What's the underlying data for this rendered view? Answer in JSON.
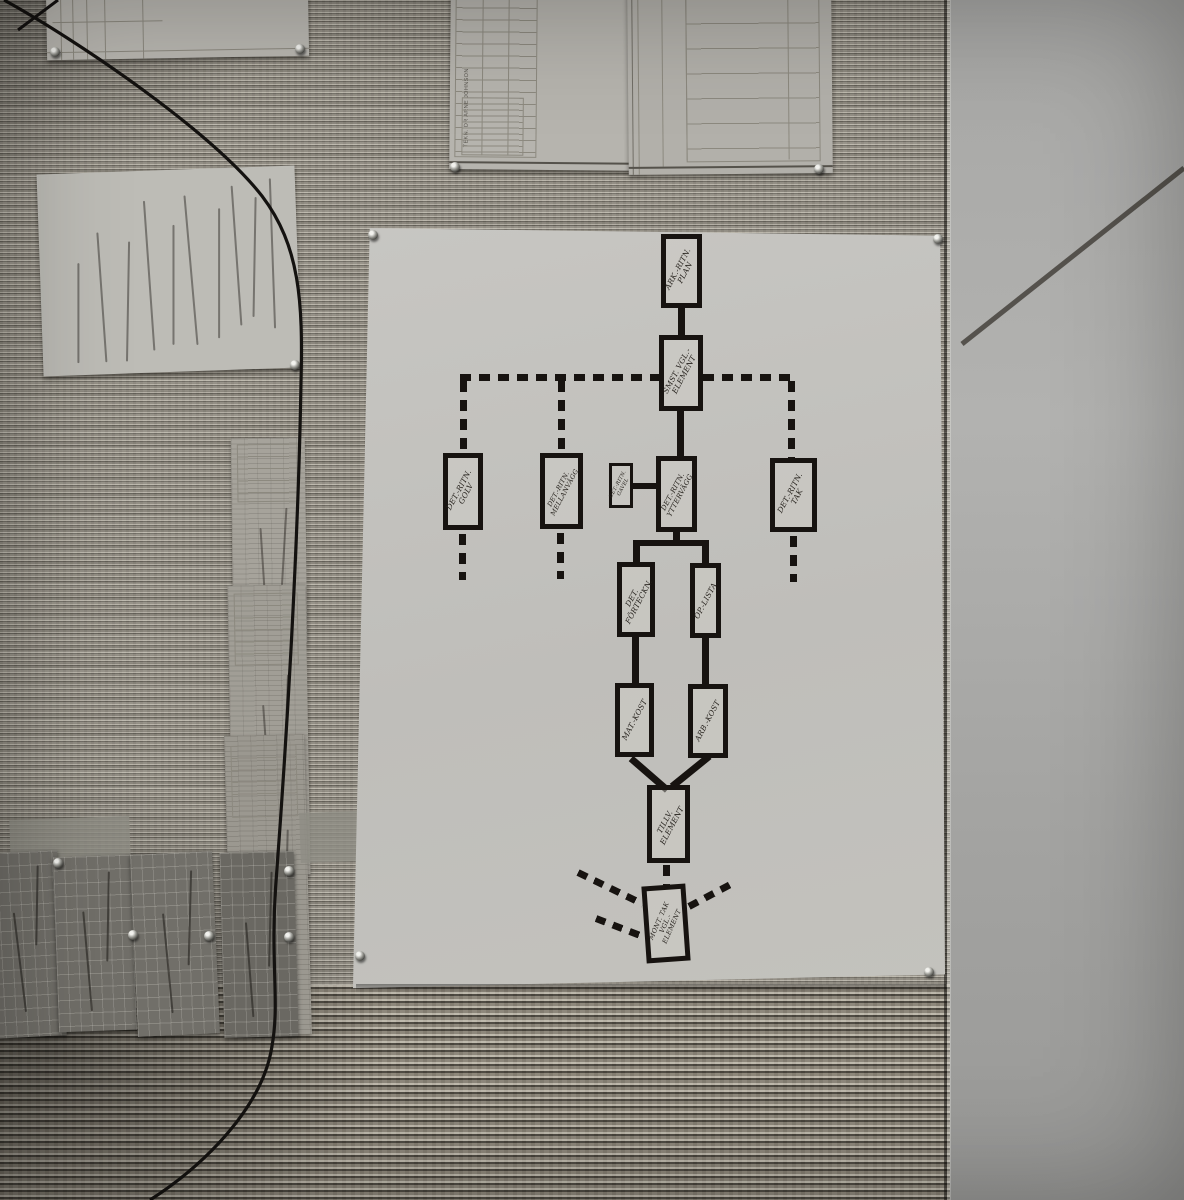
{
  "flowchart": {
    "nodes": [
      {
        "id": "plan",
        "label": "ARK.-RITN. PLAN"
      },
      {
        "id": "samst",
        "label": "SMST. VGL.-ELEMENT"
      },
      {
        "id": "golv",
        "label": "DET.-RITN. GOLV"
      },
      {
        "id": "mellanvagg",
        "label": "DET.-RITN. MELLANVÄGG"
      },
      {
        "id": "gavel",
        "label": "DET.-RITN. GAVEL"
      },
      {
        "id": "yttervagg",
        "label": "DET.-RITN. YTTERVÄGG"
      },
      {
        "id": "tak",
        "label": "DET.-RITN. TAK"
      },
      {
        "id": "forteckn",
        "label": "DET. FÖRTECKN."
      },
      {
        "id": "oplista",
        "label": "OP.-LISTA"
      },
      {
        "id": "matkost",
        "label": "MAT.-KOST"
      },
      {
        "id": "arbkost",
        "label": "ARB.-KOST"
      },
      {
        "id": "tillv",
        "label": "TILLV. ELEMENT"
      },
      {
        "id": "mont",
        "label": "MONT. TAK VGL.-ELEMENT"
      }
    ]
  },
  "blueprint": {
    "firm_name": "TEKN. DR ARNE JOHNSON"
  },
  "palette": {
    "wall": "#8f8b82",
    "poster": "#c3c2bd",
    "ink": "#171310",
    "panel": "#a9a9a7"
  }
}
